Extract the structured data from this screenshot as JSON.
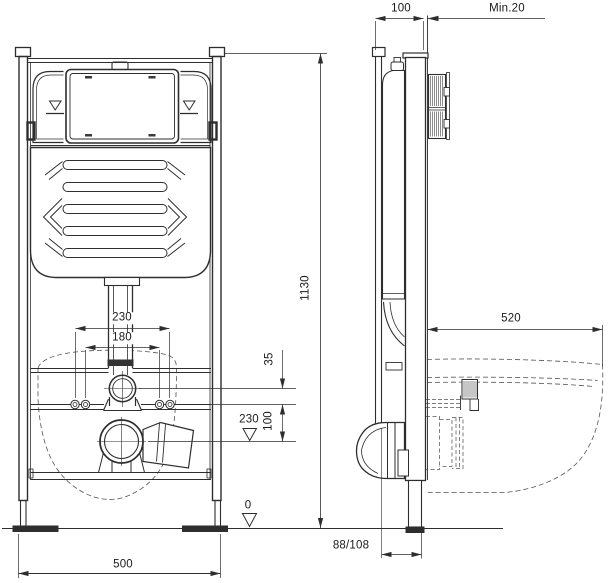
{
  "drawing": {
    "description": "Concealed WC cistern installation frame, front and side technical views",
    "colors": {
      "line": "#2e2e2e",
      "thin_line": "#555555",
      "background": "#ffffff"
    },
    "labels": {
      "frame_depth": "100",
      "min_wall": "Min.20",
      "height": "1130",
      "bolt_outer": "230",
      "bolt_inner": "180",
      "supply_offset": "35",
      "bolt_to_drain": "100",
      "drain_level": "230",
      "floor_level": "0",
      "width": "500",
      "bowl_depth": "520",
      "drain_offset": "88/108"
    }
  }
}
